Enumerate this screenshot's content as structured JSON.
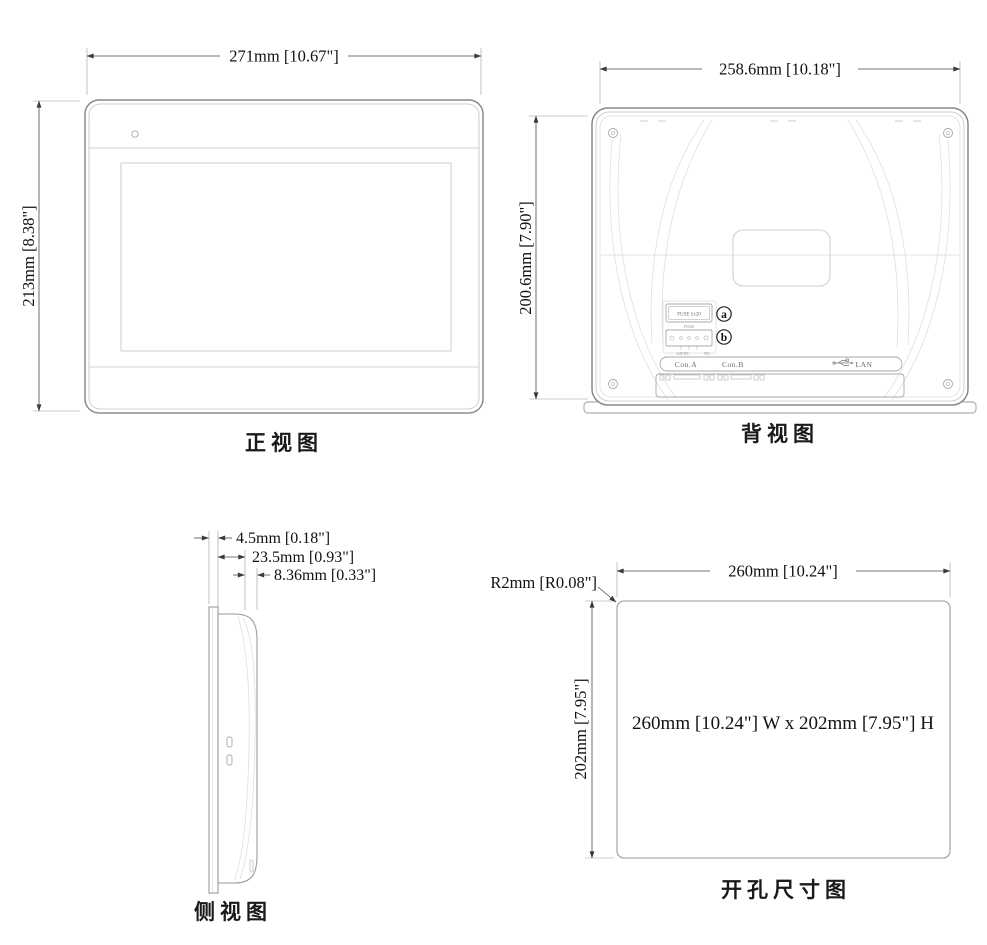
{
  "drawing": {
    "front": {
      "label": "正视图",
      "width_dim": "271mm [10.67\"]",
      "height_dim": "213mm [8.38\"]"
    },
    "back": {
      "label": "背视图",
      "width_dim": "258.6mm [10.18\"]",
      "height_dim": "200.6mm [7.90\"]",
      "fuse_box_label": "FUSE 5x20",
      "fuse_caption": "FUSE",
      "callout_a": "a",
      "callout_b": "b",
      "power_label_left": "24VDC",
      "power_label_right": "FG",
      "port_con_a": "Con.A",
      "port_con_b": "Con.B",
      "port_lan": "LAN"
    },
    "side": {
      "label": "侧视图",
      "dim_1": "4.5mm [0.18\"]",
      "dim_2": "23.5mm [0.93\"]",
      "dim_3": "8.36mm [0.33\"]"
    },
    "cutout": {
      "label": "开孔尺寸图",
      "width_dim": "260mm [10.24\"]",
      "height_dim": "202mm [7.95\"]",
      "radius_dim": "R2mm [R0.08\"]",
      "center_text": "260mm [10.24\"] W x 202mm [7.95\"] H"
    }
  },
  "colors": {
    "background": "#ffffff",
    "outline": "#8a8a8a",
    "dimension_line": "#4a4a4a",
    "text": "#111111"
  }
}
